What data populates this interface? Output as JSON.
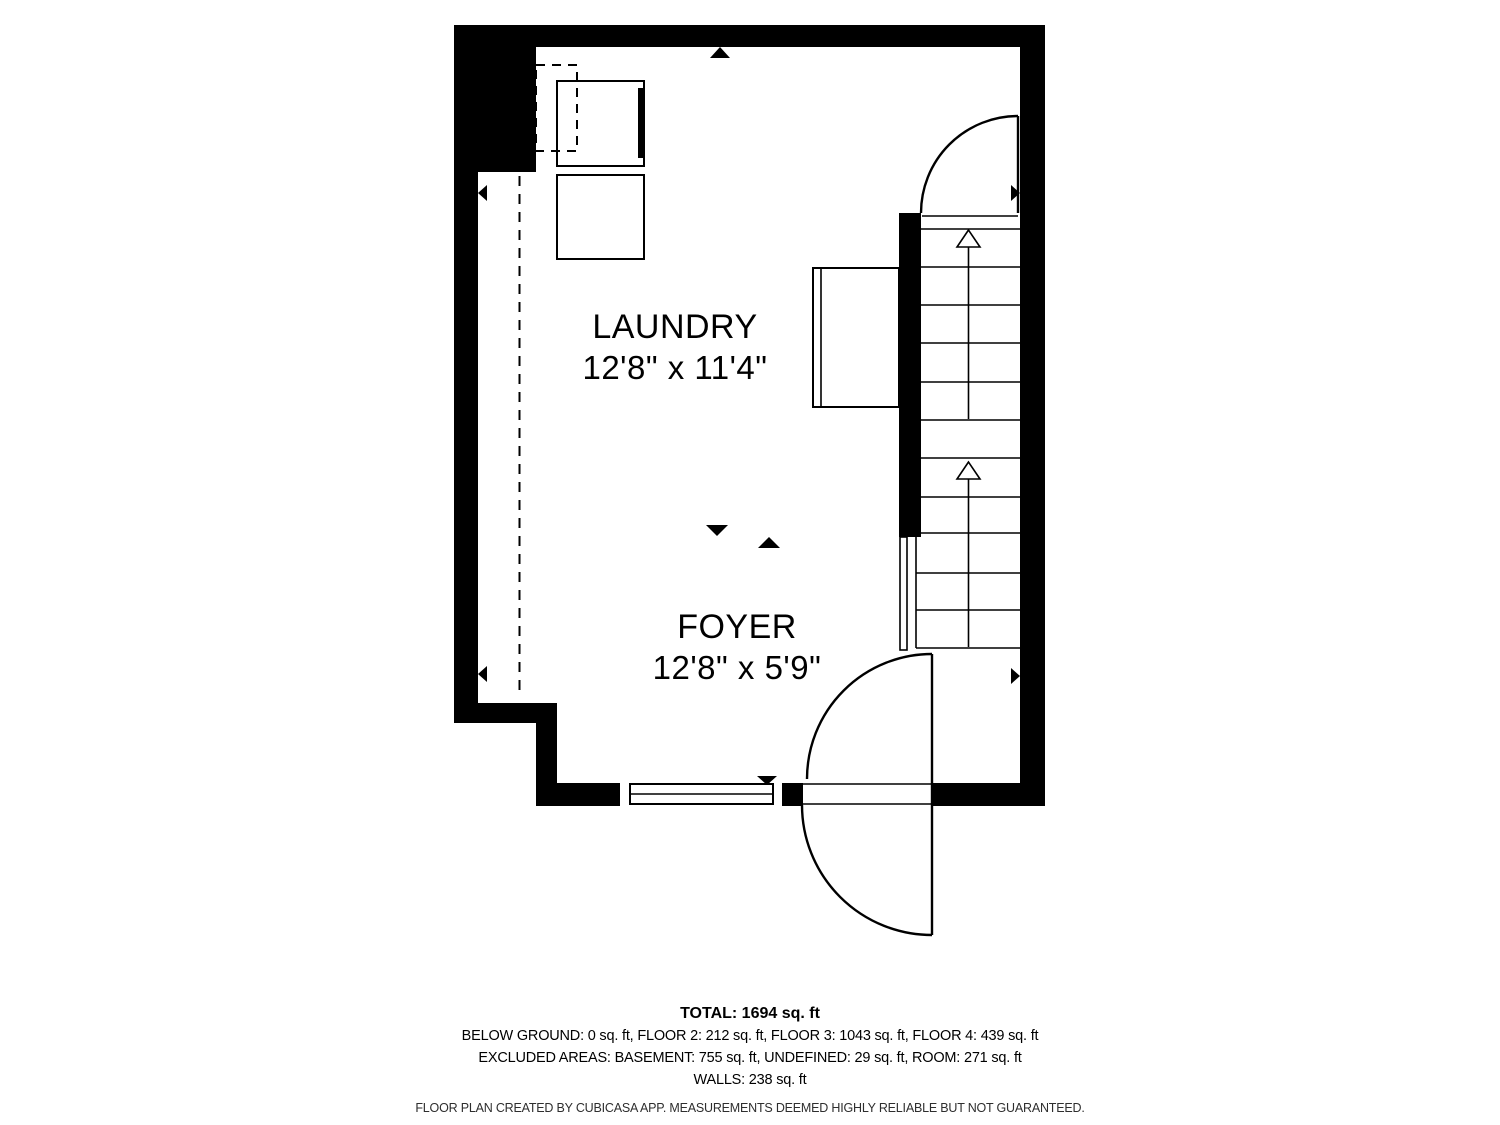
{
  "floorplan": {
    "rooms": [
      {
        "name": "LAUNDRY",
        "dimensions": "12'8\" x 11'4\""
      },
      {
        "name": "FOYER",
        "dimensions": "12'8\" x 5'9\""
      }
    ],
    "summary": {
      "total": "TOTAL: 1694 sq. ft",
      "floors": "BELOW GROUND: 0 sq. ft, FLOOR 2: 212 sq. ft, FLOOR 3: 1043 sq. ft, FLOOR 4: 439 sq. ft",
      "excluded": "EXCLUDED AREAS: BASEMENT: 755 sq. ft, UNDEFINED: 29 sq. ft, ROOM: 271 sq. ft",
      "walls": "WALLS: 238 sq. ft"
    },
    "footer": "FLOOR PLAN CREATED BY CUBICASA APP. MEASUREMENTS DEEMED HIGHLY RELIABLE BUT NOT GUARANTEED.",
    "colors": {
      "wall": "#000000",
      "background": "#ffffff",
      "line": "#000000"
    },
    "icons": {
      "stairs_direction": "stairs-up-arrow",
      "opening_markers": "solid-triangle-marker",
      "doors": "door-swing-arc",
      "window": "double-line-window"
    }
  }
}
